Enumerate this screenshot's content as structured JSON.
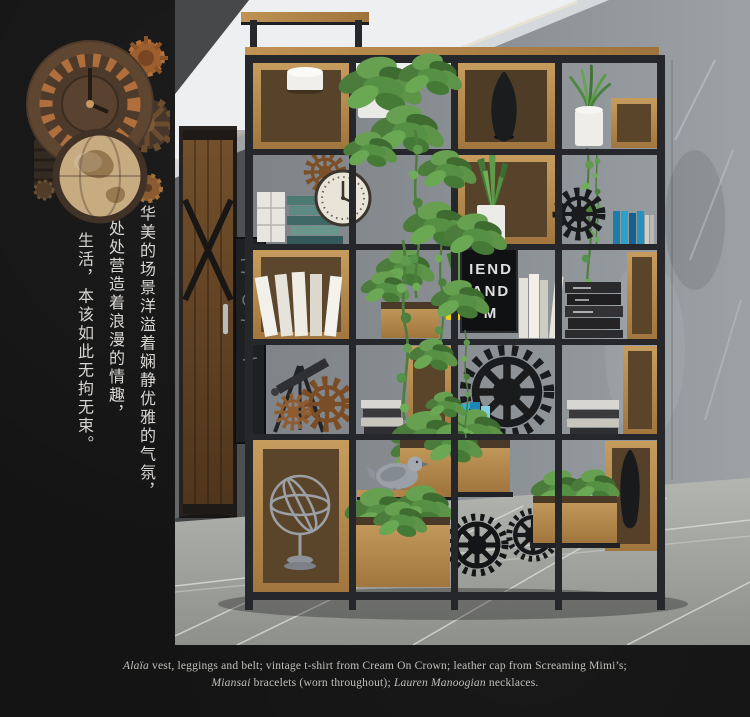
{
  "page": {
    "background": "#141414"
  },
  "sidebar": {
    "vertical_caption": {
      "line1": "华美的场景洋溢着娴静优雅的气氛，",
      "line2": "处处营造着浪漫的情趣，",
      "line3": "生活，本该如此无拘无束。"
    }
  },
  "photo": {
    "poster": {
      "line1": "IEND",
      "line2": "AND",
      "line3": "M"
    },
    "palette": {
      "wall_concrete": "#8b9094",
      "wood": "#b5854a",
      "metal_frame": "#25272b",
      "floor_tile": "#a6a8a4",
      "foliage": "#5f9a4d",
      "pot_yellow": "#ecd216",
      "books_blue": "#2aa3c8",
      "books_teal": "#4c7a72"
    }
  },
  "footer": {
    "credit": {
      "brand1": "Alaïa",
      "text1": " vest, leggings and belt; vintage t-shirt from Cream On Crown; leather cap from Screaming Mimi’s;",
      "brand2": "Miansai",
      "text2": " bracelets (worn throughout); ",
      "brand3": "Lauren Manoogian",
      "text3": " necklaces."
    }
  }
}
